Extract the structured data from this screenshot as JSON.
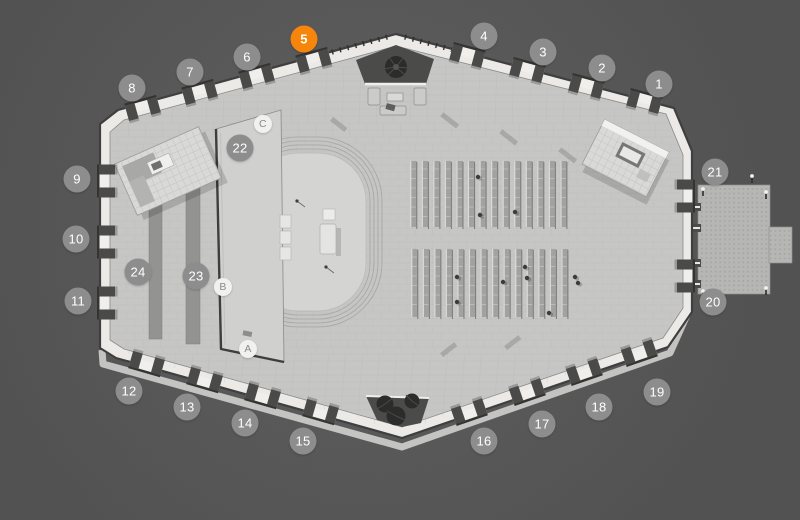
{
  "map": {
    "description": "venue-floor-plan",
    "selected_marker": "5",
    "colors": {
      "background": "#575757",
      "floor": "#c6c6c4",
      "wall_band": "#eceae7",
      "wall_line": "#3f3f3f",
      "marker_default": "#8d8d8d",
      "marker_selected": "#f6860b",
      "marker_text": "#ffffff",
      "letter_marker_bg": "#f1f1ef",
      "letter_marker_text": "#8a8a8a"
    },
    "number_markers": [
      {
        "label": "1",
        "x": 659,
        "y": 84,
        "selected": false
      },
      {
        "label": "2",
        "x": 602,
        "y": 68,
        "selected": false
      },
      {
        "label": "3",
        "x": 543,
        "y": 52,
        "selected": false
      },
      {
        "label": "4",
        "x": 484,
        "y": 36,
        "selected": false
      },
      {
        "label": "5",
        "x": 304,
        "y": 39,
        "selected": true
      },
      {
        "label": "6",
        "x": 247,
        "y": 57,
        "selected": false
      },
      {
        "label": "7",
        "x": 190,
        "y": 72,
        "selected": false
      },
      {
        "label": "8",
        "x": 132,
        "y": 88,
        "selected": false
      },
      {
        "label": "9",
        "x": 77,
        "y": 179,
        "selected": false
      },
      {
        "label": "10",
        "x": 76,
        "y": 239,
        "selected": false
      },
      {
        "label": "11",
        "x": 78,
        "y": 301,
        "selected": false
      },
      {
        "label": "12",
        "x": 129,
        "y": 391,
        "selected": false
      },
      {
        "label": "13",
        "x": 187,
        "y": 407,
        "selected": false
      },
      {
        "label": "14",
        "x": 245,
        "y": 423,
        "selected": false
      },
      {
        "label": "15",
        "x": 303,
        "y": 441,
        "selected": false
      },
      {
        "label": "16",
        "x": 484,
        "y": 441,
        "selected": false
      },
      {
        "label": "17",
        "x": 542,
        "y": 424,
        "selected": false
      },
      {
        "label": "18",
        "x": 599,
        "y": 407,
        "selected": false
      },
      {
        "label": "19",
        "x": 657,
        "y": 392,
        "selected": false
      },
      {
        "label": "20",
        "x": 713,
        "y": 302,
        "selected": false
      },
      {
        "label": "21",
        "x": 715,
        "y": 172,
        "selected": false
      },
      {
        "label": "22",
        "x": 240,
        "y": 148,
        "selected": false
      },
      {
        "label": "23",
        "x": 196,
        "y": 276,
        "selected": false
      },
      {
        "label": "24",
        "x": 138,
        "y": 272,
        "selected": false
      }
    ],
    "letter_markers": [
      {
        "label": "A",
        "x": 248,
        "y": 349
      },
      {
        "label": "B",
        "x": 223,
        "y": 287
      },
      {
        "label": "C",
        "x": 263,
        "y": 124
      }
    ]
  }
}
